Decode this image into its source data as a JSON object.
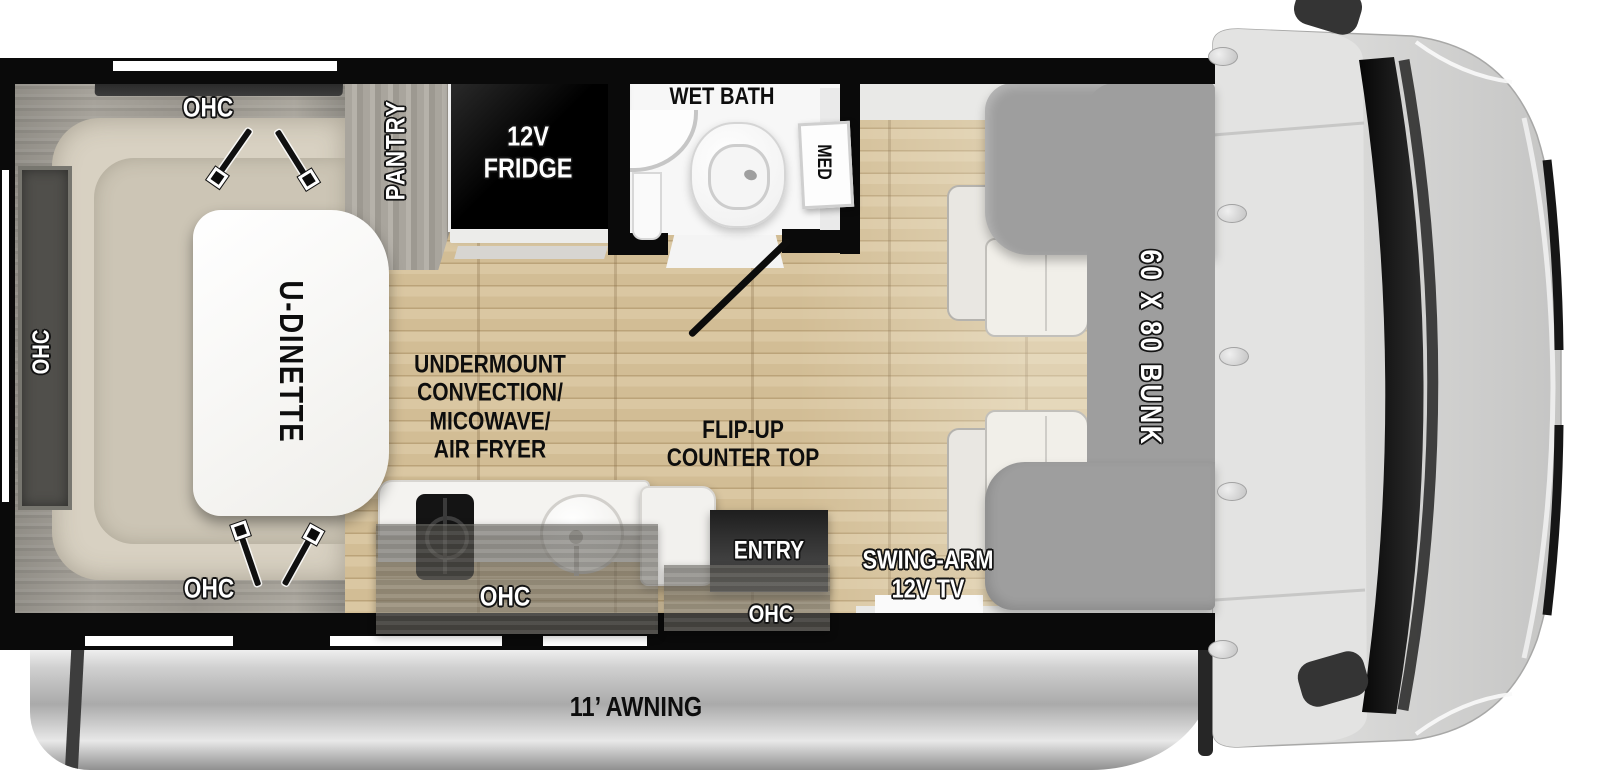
{
  "labels": {
    "ohc_top": "OHC",
    "ohc_left": "OHC",
    "ohc_bottom": "OHC",
    "ohc_kitchen": "OHC",
    "ohc_entry": "OHC",
    "pantry": "PANTRY",
    "fridge_line1": "12V",
    "fridge_line2": "FRIDGE",
    "wet_bath": "WET BATH",
    "med": "MED",
    "u_dinette": "U-DINETTE",
    "undermount_line1": "UNDERMOUNT",
    "undermount_line2": "CONVECTION/",
    "undermount_line3": "MICOWAVE/",
    "undermount_line4": "AIR FRYER",
    "flip_up_line1": "FLIP-UP",
    "flip_up_line2": "COUNTER TOP",
    "entry": "ENTRY",
    "swing_arm_line1": "SWING-ARM",
    "swing_arm_line2": "12V TV",
    "bunk": "60 X 80 BUNK",
    "awning": "11’ AWNING"
  },
  "colors": {
    "wall_black": "#0a0a0a",
    "floor_wood": "#d7c39c",
    "bunk_gray": "#9e9e9e",
    "cushion_beige": "#d8d1c2",
    "cabinet_wood_gray": "#a8a49c",
    "awning_silver": "#c2c2c2",
    "fixture_white": "#f6f6f4",
    "label_white": "#ffffff",
    "label_black": "#0d0d0d"
  }
}
